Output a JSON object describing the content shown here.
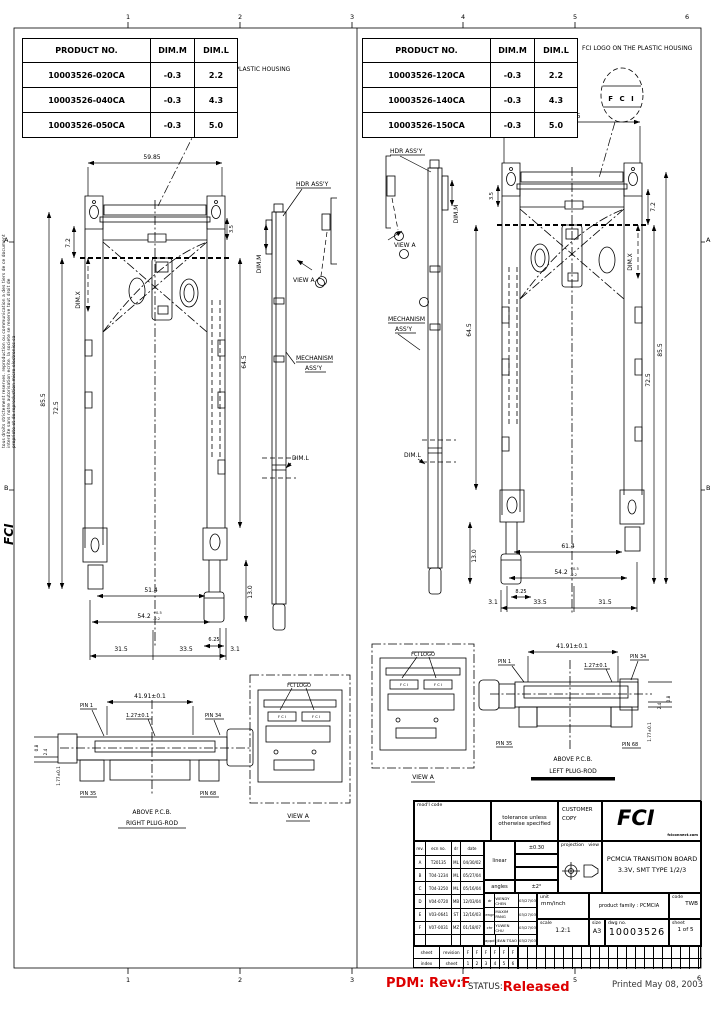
{
  "page": {
    "cols": [
      "1",
      "2",
      "3",
      "4",
      "5",
      "6"
    ],
    "rows_left": [
      "A",
      "B"
    ],
    "rows_right": [
      "A",
      "B"
    ],
    "margin_note_1": "tous droits strictement reserves. reproduction ou communication a des tiers de ce document",
    "margin_note_2": "interdite sans notre autorisation ecrite. la societe se reserve tout droit de",
    "margin_note_3": "propriete et de reproduction  micro electronics sa",
    "margin_logo": "FCI",
    "accent_red": "#dd0000"
  },
  "spec_tables": {
    "headers": [
      "PRODUCT  NO.",
      "DIM.M",
      "DIM.L"
    ],
    "left_rows": [
      [
        "10003526-020CA",
        "-0.3",
        "2.2"
      ],
      [
        "10003526-040CA",
        "-0.3",
        "4.3"
      ],
      [
        "10003526-050CA",
        "-0.3",
        "5.0"
      ]
    ],
    "right_rows": [
      [
        "10003526-120CA",
        "-0.3",
        "2.2"
      ],
      [
        "10003526-140CA",
        "-0.3",
        "4.3"
      ],
      [
        "10003526-150CA",
        "-0.3",
        "5.0"
      ]
    ]
  },
  "callouts": {
    "logo_note": "FCI LOGO ON THE PLASTIC HOUSING",
    "fci_mark": "F C I",
    "fci_logo_label": "FCI LOGO",
    "hdr_assy": "HDR ASS'Y",
    "mechanism_1": "MECHANISM",
    "mechanism_2": "ASS'Y",
    "view_a": "VIEW A",
    "pin_1": "PIN 1",
    "pin_34": "PIN 34",
    "pin_35": "PIN 35",
    "pin_68": "PIN 68",
    "above_pcb": "ABOVE P.C.B.",
    "right_rod": "RIGHT PLUG-ROD",
    "left_rod": "LEFT PLUG-ROD"
  },
  "dims": {
    "left_width": "59.85",
    "right_width": "69.85",
    "h_outer": "85.5",
    "h_inner": "72.5",
    "h_mid": "64.5",
    "top_offset": "7.2",
    "edge": "3.5",
    "foot": "13.0",
    "inner_left": "51.4",
    "inner_right": "61.4",
    "body": "54.2",
    "body_tol_plus": "+0.5",
    "body_tol_minus": "-0.2",
    "b1": "31.5",
    "b2": "33.5",
    "b3": "3.1",
    "rod_left": "6.25",
    "rod_right": "8.25",
    "pitch_total": "41.91±0.1",
    "pitch": "1.27±0.1",
    "height_pin": "1.77±0.1",
    "d24": "2.4",
    "d08": "0.8",
    "dim_m": "DIM.M",
    "dim_x": "DIM.X",
    "dim_l": "DIM.L"
  },
  "titleblock": {
    "model_code_label": "mod'l code",
    "tolerance_heading": "tolerance unless otherwise specified",
    "customer_copy_1": "CUSTOMER",
    "customer_copy_2": "COPY",
    "logo_text": "FCI",
    "logo_sub": "fciconnect.com",
    "rev_headers": [
      "rev.",
      "ecn no.",
      "dr",
      "date"
    ],
    "rev_rows": [
      [
        "A",
        "T20135",
        "ML",
        "04/30/02"
      ],
      [
        "B",
        "T04-1234",
        "ML",
        "05/27/04"
      ],
      [
        "C",
        "T04-3250",
        "ML",
        "05/16/04"
      ],
      [
        "D",
        "V04-0720",
        "MB",
        "12/03/04"
      ],
      [
        "E",
        "V03-0641",
        "ST",
        "12/16/03"
      ],
      [
        "F",
        "V07-0031",
        "MZ",
        "01/18/07"
      ]
    ],
    "linear_label": "linear",
    "linear_value": "±0.30",
    "angles_label": "angles",
    "angles_value": "±2°",
    "approvals": [
      {
        "role": "dr",
        "name": "WENDY CHEN",
        "date": "03/27/03"
      },
      {
        "role": "engr",
        "name": "MAXIM PANG",
        "date": "03/27/03"
      },
      {
        "role": "chr",
        "name": "YUWEN CHU",
        "date": "03/27/03"
      },
      {
        "role": "appd",
        "name": "JEAN TSAO",
        "date": "03/27/03"
      }
    ],
    "projection_label": "projection",
    "view_label": "view",
    "title_1": "PCMCIA TRANSITION BOARD",
    "title_2": "3.3V, SMT TYPE 1/2/3",
    "unit_label": "unit",
    "unit_value": "mm/inch",
    "family_label": "product family : PCMCIA",
    "code_label": "code",
    "code_value": "TWB",
    "size_label": "size",
    "size_value": "A3",
    "dwg_label": "dwg no.",
    "dwg_value": "10003526",
    "scale_label": "scale",
    "scale_value": "1.2:1",
    "sheet_label": "sheet",
    "sheet_value": "1 of 5",
    "strip_row1_a": "sheet",
    "strip_row1_b": "revision",
    "strip_row2_a": "index",
    "strip_row2_b": "sheet",
    "strip_revs": [
      "F",
      "F",
      "F",
      "F",
      "F",
      "F"
    ],
    "strip_nums": [
      "1",
      "2",
      "3",
      "4",
      "5",
      "6"
    ]
  },
  "status_bar": {
    "pdm": "PDM: Rev:F",
    "status_label": "STATUS:",
    "status_value": "Released",
    "printed": "Printed May 08, 2003"
  }
}
